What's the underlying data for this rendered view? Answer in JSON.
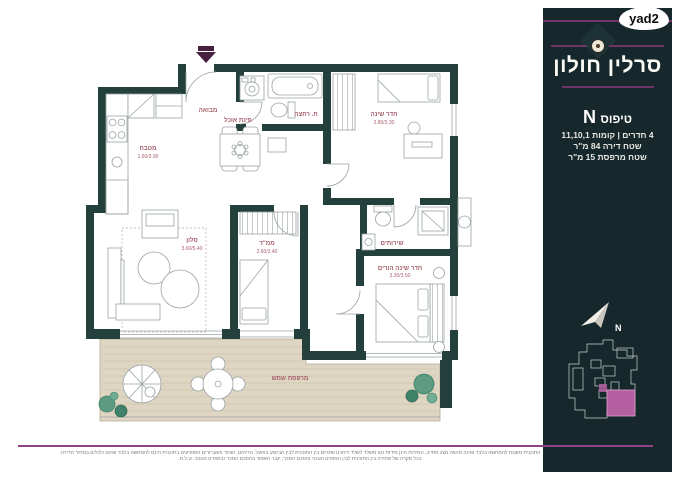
{
  "brand": {
    "logo": "yad2"
  },
  "sidebar": {
    "title": "סרלין חולון",
    "type_label": "טיפוס",
    "type_letter": "N",
    "specs": [
      "4 חדרים | קומות 11,10,1",
      "שטח דירה 84 מ\"ר",
      "שטח מרפסת 15 מ\"ר"
    ],
    "north": "N"
  },
  "plan": {
    "rooms": [
      {
        "name": "מטבח",
        "dim": "1.60/3.90"
      },
      {
        "name": "פינת אוכל",
        "dim": ""
      },
      {
        "name": "מבואה",
        "dim": ""
      },
      {
        "name": "ח. רחצה",
        "dim": ""
      },
      {
        "name": "חדר שינה",
        "dim": "2.80/3.30"
      },
      {
        "name": "סלון",
        "dim": "3.60/5.40"
      },
      {
        "name": "ממ\"ד",
        "dim": "2.60/3.40"
      },
      {
        "name": "שירותים",
        "dim": ""
      },
      {
        "name": "חדר שינה הורים",
        "dim": "3.30/3.50"
      },
      {
        "name": "מרפסת שמש",
        "dim": ""
      }
    ]
  },
  "disclaimer": {
    "line1": "התוכנית מוצגת להמחשה בלבד ואינה מהווה מצג מחייב. המידות הינן מידות נטו משלד לשלד וייתכנו שינויים בין התוכנית לבין הביצוע בפועל. הריהוט, הציוד והאביזרים המופיעים בתוכנית הינם להמחשה בלבד ואינם כלולים במחיר הדירה.",
    "line2": "בכל מקרה של סתירה בין התוכנית לבין המפרט הטכני והסכם המכר, יגבר האמור בהסכם המכר ובמפרט הטכני. ט.ל.ח."
  },
  "colors": {
    "wall": "#24403c",
    "panel": "#16282b",
    "accent_purple": "#6e3468",
    "footer_line": "#8d4287",
    "label_pink": "#a85f6b",
    "balcony_floor": "#ded5c2",
    "keyplan_highlight": "#b35fa0",
    "entry_arrow": "#47203f",
    "plant_green": "#5d9b82"
  }
}
